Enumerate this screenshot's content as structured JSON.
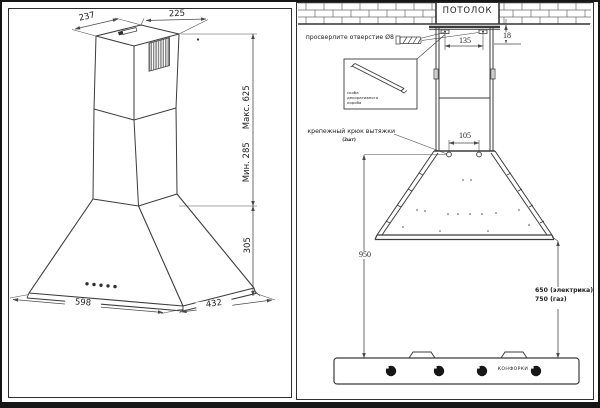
{
  "colors": {
    "line": "#3b3b3b",
    "dim_line": "#4a4a4a",
    "text": "#1d1d1d",
    "knob": "#161616",
    "background": "#ffffff"
  },
  "left_panel": {
    "dims": {
      "top_depth": "237",
      "top_width": "225",
      "chimney_max": "Макс. 625",
      "chimney_min": "Мин. 285",
      "canopy_height": "305",
      "body_width": "598",
      "body_depth": "432"
    }
  },
  "right_panel": {
    "ceiling": "ПОТОЛОК",
    "drill_note": "просверлите отверстие Ø8",
    "duct_bracket_caption_lines": [
      "скоба",
      "декоративного",
      "короба"
    ],
    "hook_note": "крепежный крюк вытяжки",
    "hook_note_sub": "(2шт)",
    "burners_label": "КОНФОРКИ",
    "dims": {
      "bracket_spacing": "135",
      "ceiling_gap": "18",
      "hook_spacing": "105",
      "hook_to_hob": "950",
      "electric_height": "650 (электрика)",
      "gas_height": "750 (газ)"
    }
  }
}
